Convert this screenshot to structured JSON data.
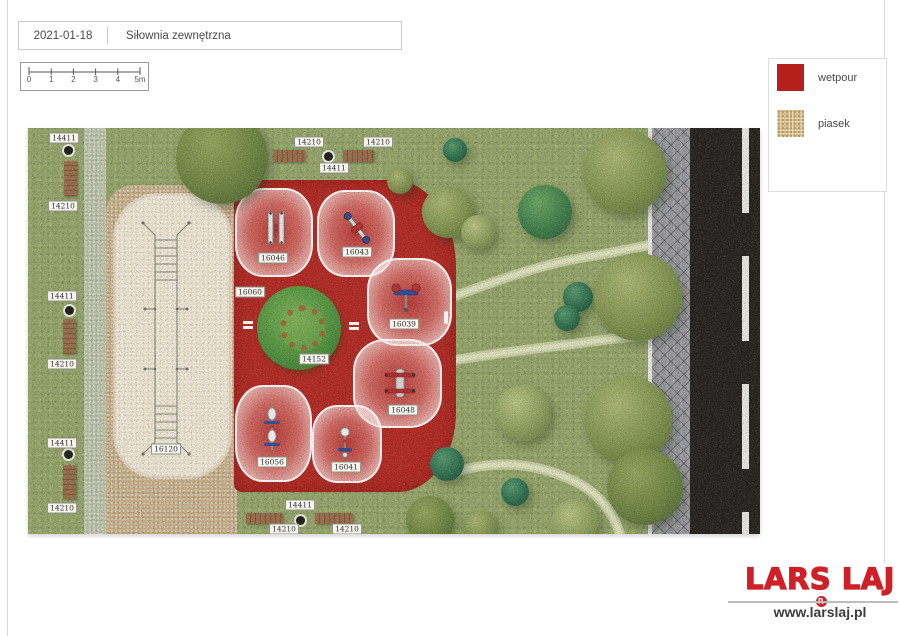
{
  "header": {
    "date": "2021-01-18",
    "title": "Siłownia zewnętrzna"
  },
  "scale_bar": {
    "tick_labels": [
      "0",
      "1",
      "2",
      "3",
      "4",
      "5m"
    ]
  },
  "legend": {
    "items": [
      {
        "label": "wetpour",
        "color": "#b51f1c"
      },
      {
        "label": "piasek",
        "color": "#cfb585"
      }
    ]
  },
  "footer": {
    "logo": "LARS LAJ",
    "registered": "R",
    "website": "www.larslaj.pl",
    "logo_color": "#cf2028"
  },
  "map": {
    "labels": [
      {
        "text": "14411",
        "x": 36,
        "y": 10
      },
      {
        "text": "14210",
        "x": 35,
        "y": 78
      },
      {
        "text": "14411",
        "x": 34,
        "y": 168
      },
      {
        "text": "14210",
        "x": 34,
        "y": 236
      },
      {
        "text": "14411",
        "x": 34,
        "y": 315
      },
      {
        "text": "14210",
        "x": 34,
        "y": 380
      },
      {
        "text": "14210",
        "x": 281,
        "y": 14
      },
      {
        "text": "14210",
        "x": 350,
        "y": 14
      },
      {
        "text": "14411",
        "x": 306,
        "y": 40
      },
      {
        "text": "14411",
        "x": 272,
        "y": 377
      },
      {
        "text": "14210",
        "x": 256,
        "y": 401
      },
      {
        "text": "14210",
        "x": 319,
        "y": 401
      },
      {
        "text": "16046",
        "x": 245,
        "y": 130
      },
      {
        "text": "16043",
        "x": 329,
        "y": 124
      },
      {
        "text": "16060",
        "x": 222,
        "y": 164
      },
      {
        "text": "16039",
        "x": 376,
        "y": 196
      },
      {
        "text": "14152",
        "x": 286,
        "y": 231
      },
      {
        "text": "16048",
        "x": 375,
        "y": 282
      },
      {
        "text": "16056",
        "x": 244,
        "y": 334
      },
      {
        "text": "16041",
        "x": 318,
        "y": 339
      },
      {
        "text": "16120",
        "x": 138,
        "y": 321
      }
    ],
    "zones": [
      {
        "id": "16046",
        "x": 207,
        "y": 60,
        "w": 78,
        "h": 89,
        "icon": "parallel-bars",
        "ix": 248,
        "iy": 100
      },
      {
        "id": "16043",
        "x": 289,
        "y": 62,
        "w": 78,
        "h": 87,
        "icon": "twister",
        "ix": 329,
        "iy": 100
      },
      {
        "id": "16039",
        "x": 339,
        "y": 130,
        "w": 85,
        "h": 88,
        "icon": "chest-press",
        "ix": 378,
        "iy": 172
      },
      {
        "id": "16048",
        "x": 325,
        "y": 211,
        "w": 89,
        "h": 89,
        "icon": "bench",
        "ix": 372,
        "iy": 256
      },
      {
        "id": "16056",
        "x": 207,
        "y": 257,
        "w": 77,
        "h": 97,
        "icon": "pull-station",
        "ix": 244,
        "iy": 300
      },
      {
        "id": "16041",
        "x": 284,
        "y": 277,
        "w": 70,
        "h": 78,
        "icon": "bike",
        "ix": 317,
        "iy": 318
      }
    ],
    "tree_ring": {
      "x": 271,
      "y": 200,
      "r": 42,
      "ring_r": 17
    },
    "trees": [
      {
        "x": 194,
        "y": 30,
        "r": 46,
        "tone": "olive-deep"
      },
      {
        "x": 420,
        "y": 84,
        "r": 26,
        "tone": "olive"
      },
      {
        "x": 372,
        "y": 53,
        "r": 13,
        "tone": "olive"
      },
      {
        "x": 427,
        "y": 22,
        "r": 12,
        "tone": "teal"
      },
      {
        "x": 517,
        "y": 84,
        "r": 27,
        "tone": "green"
      },
      {
        "x": 450,
        "y": 104,
        "r": 17,
        "tone": "olive-light"
      },
      {
        "x": 597,
        "y": 44,
        "r": 42,
        "tone": "olive"
      },
      {
        "x": 550,
        "y": 169,
        "r": 15,
        "tone": "teal"
      },
      {
        "x": 539,
        "y": 190,
        "r": 13,
        "tone": "teal"
      },
      {
        "x": 610,
        "y": 169,
        "r": 44,
        "tone": "olive"
      },
      {
        "x": 600,
        "y": 292,
        "r": 44,
        "tone": "olive"
      },
      {
        "x": 495,
        "y": 285,
        "r": 28,
        "tone": "olive-light"
      },
      {
        "x": 419,
        "y": 336,
        "r": 17,
        "tone": "teal"
      },
      {
        "x": 487,
        "y": 364,
        "r": 14,
        "tone": "teal"
      },
      {
        "x": 617,
        "y": 359,
        "r": 38,
        "tone": "olive-deep"
      },
      {
        "x": 547,
        "y": 395,
        "r": 24,
        "tone": "olive-light"
      },
      {
        "x": 452,
        "y": 399,
        "r": 17,
        "tone": "olive"
      },
      {
        "x": 402,
        "y": 392,
        "r": 24,
        "tone": "olive-deep"
      }
    ],
    "benches": [
      {
        "x": 36,
        "y": 33,
        "w": 13,
        "h": 35,
        "o": "v"
      },
      {
        "x": 35,
        "y": 191,
        "w": 13,
        "h": 35,
        "o": "v"
      },
      {
        "x": 35,
        "y": 337,
        "w": 13,
        "h": 34,
        "o": "v"
      },
      {
        "x": 245,
        "y": 22,
        "w": 32,
        "h": 12,
        "o": "h"
      },
      {
        "x": 315,
        "y": 22,
        "w": 31,
        "h": 12,
        "o": "h"
      },
      {
        "x": 218,
        "y": 385,
        "w": 37,
        "h": 11,
        "o": "h"
      },
      {
        "x": 287,
        "y": 385,
        "w": 38,
        "h": 11,
        "o": "h"
      }
    ],
    "bins": [
      {
        "x": 40,
        "y": 22
      },
      {
        "x": 41,
        "y": 182
      },
      {
        "x": 40,
        "y": 326
      },
      {
        "x": 300,
        "y": 28
      },
      {
        "x": 272,
        "y": 392
      }
    ],
    "markers": [
      {
        "x": 220,
        "y": 198,
        "o": "h"
      },
      {
        "x": 326,
        "y": 199,
        "o": "h"
      },
      {
        "x": 421,
        "y": 188,
        "o": "v"
      }
    ],
    "paths": [
      "M427,168 C470,152 515,136 558,129 C600,122 635,114 666,108",
      "M427,232 C475,224 515,220 552,215 C595,209 632,206 666,204",
      "M420,346 C468,331 508,334 548,354 C572,366 586,386 592,406"
    ]
  }
}
